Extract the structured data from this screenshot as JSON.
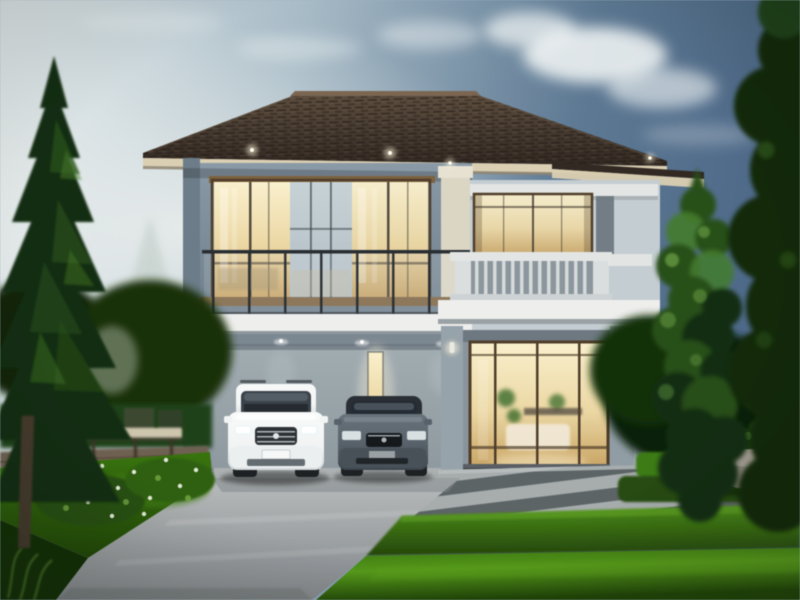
{
  "scene": {
    "type": "photorealistic-architectural-rendering",
    "description": "Modern two-storey grey house at dusk with warm lit windows, a balcony, a carport sheltering a white SUV and a dark grey sedan, a glass entry door, striped stone pavement, bright hedges and lawn, tall conifer and leafy trees on both sides under a hazy blue sky",
    "objects": {
      "sky": {
        "condition": "hazy dusk with soft clouds",
        "bright_side": "left",
        "dark_side": "right"
      },
      "house": {
        "storeys": 2,
        "roof": "dark brown hipped tile roof with cream fascia",
        "walls": [
          "grey-blue main block",
          "light grey right wing"
        ],
        "balconies": [
          "dark-railing balcony over carport",
          "white balustrade balcony on right wing"
        ],
        "lit_windows": 4,
        "eave_downlights": 4,
        "wall_sconces": 3
      },
      "vehicles": [
        {
          "name": "suv",
          "color": "white",
          "position": "left carport bay"
        },
        {
          "name": "sedan",
          "color": "dark grey",
          "position": "right carport bay"
        }
      ],
      "landscape": {
        "left": [
          "tall dark conifer tree",
          "garden furniture set",
          "paved patio",
          "flowering shrubs",
          "lawn"
        ],
        "right": [
          "bright leafy tree",
          "dark edge tree",
          "stone bowl planter",
          "hedge rows"
        ],
        "front": [
          "concrete driveway",
          "striped stone pavement",
          "trimmed hedge band",
          "bright lawn"
        ]
      }
    }
  },
  "palette": {
    "sky-left": "#e3e9ea",
    "sky-mid": "#a7b9c4",
    "sky-right": "#5f7991",
    "sky-deep": "#4f6886",
    "cloud": "#f3f6f5",
    "mist": "#b9c4bd",
    "roof-hi": "#5d4e40",
    "roof-lo": "#332b25",
    "roof-ridge": "#7a6754",
    "fascia-cream": "#d8cdb2",
    "fascia-shadow": "#8d8573",
    "wall-blue": "#8a99a5",
    "wall-blue-dk": "#6d7c87",
    "wing-wall": "#c3cbd0",
    "wing-trim": "#e0e3e2",
    "pilaster-cream": "#d9d4c3",
    "pilaster-dk": "#6a747c",
    "bronze": "#7d6342",
    "bronze-dk": "#4f3f2c",
    "warm-hi": "#f7eecd",
    "warm-mid": "#e8d5a5",
    "warm-lo": "#c5a367",
    "glass-cool": "#b0bcc2",
    "glass-dk": "#343b40",
    "rail-dk": "#2b3034",
    "rail-lt": "#d8dcdd",
    "fascia-white": "#ececea",
    "soffit": "#7d8890",
    "carport-hi": "#a3adb2",
    "carport-lo": "#8d979d",
    "slab": "#abafb0",
    "suv-body": "#f0f2f2",
    "suv-shade": "#d2d7d8",
    "suv-dk": "#2e3337",
    "sedan-body": "#59626a",
    "sedan-dk": "#2b3135",
    "car-glass": "#3c444a",
    "tire": "#1f2326",
    "drive-hi": "#b7babb",
    "drive-lo": "#83878a",
    "pave-lt": "#a6abac",
    "pave-dk": "#5d6466",
    "hedge-hi": "#4f8d20",
    "hedge-lo": "#27460f",
    "lawn-hi": "#5a9a22",
    "lawn-mid": "#3c7415",
    "lawn-lo": "#24470c",
    "tree-dk": "#182f12",
    "tree-md": "#2c4f1f",
    "tree-lt": "#477a31",
    "tree-pale": "#6fa14b",
    "trunk": "#453a2e",
    "patio": "#6e6253",
    "furn-lt": "#ccc4ad",
    "stone": "#89847b",
    "glow": "#fff6da",
    "step-dk": "#3e4346",
    "flower": "#f2f4ea"
  }
}
